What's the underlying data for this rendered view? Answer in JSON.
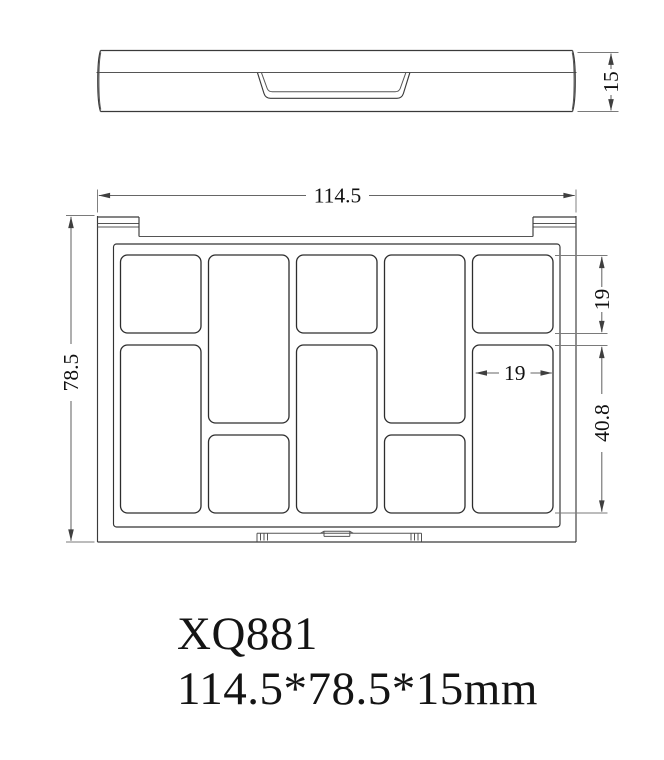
{
  "drawing": {
    "side_view": {
      "height_dim": "15"
    },
    "top_view": {
      "width_dim": "114.5",
      "height_dim": "78.5",
      "pan_height_dim": "19",
      "pan_width_dim": "19",
      "large_pan_height_dim": "40.8"
    },
    "title": {
      "model": "XQ881",
      "dimensions": "114.5*78.5*15mm"
    },
    "colors": {
      "outline": "#3a3a3a",
      "dimension_lines": "#7a7a7a",
      "text": "#141414",
      "background": "#ffffff"
    }
  }
}
